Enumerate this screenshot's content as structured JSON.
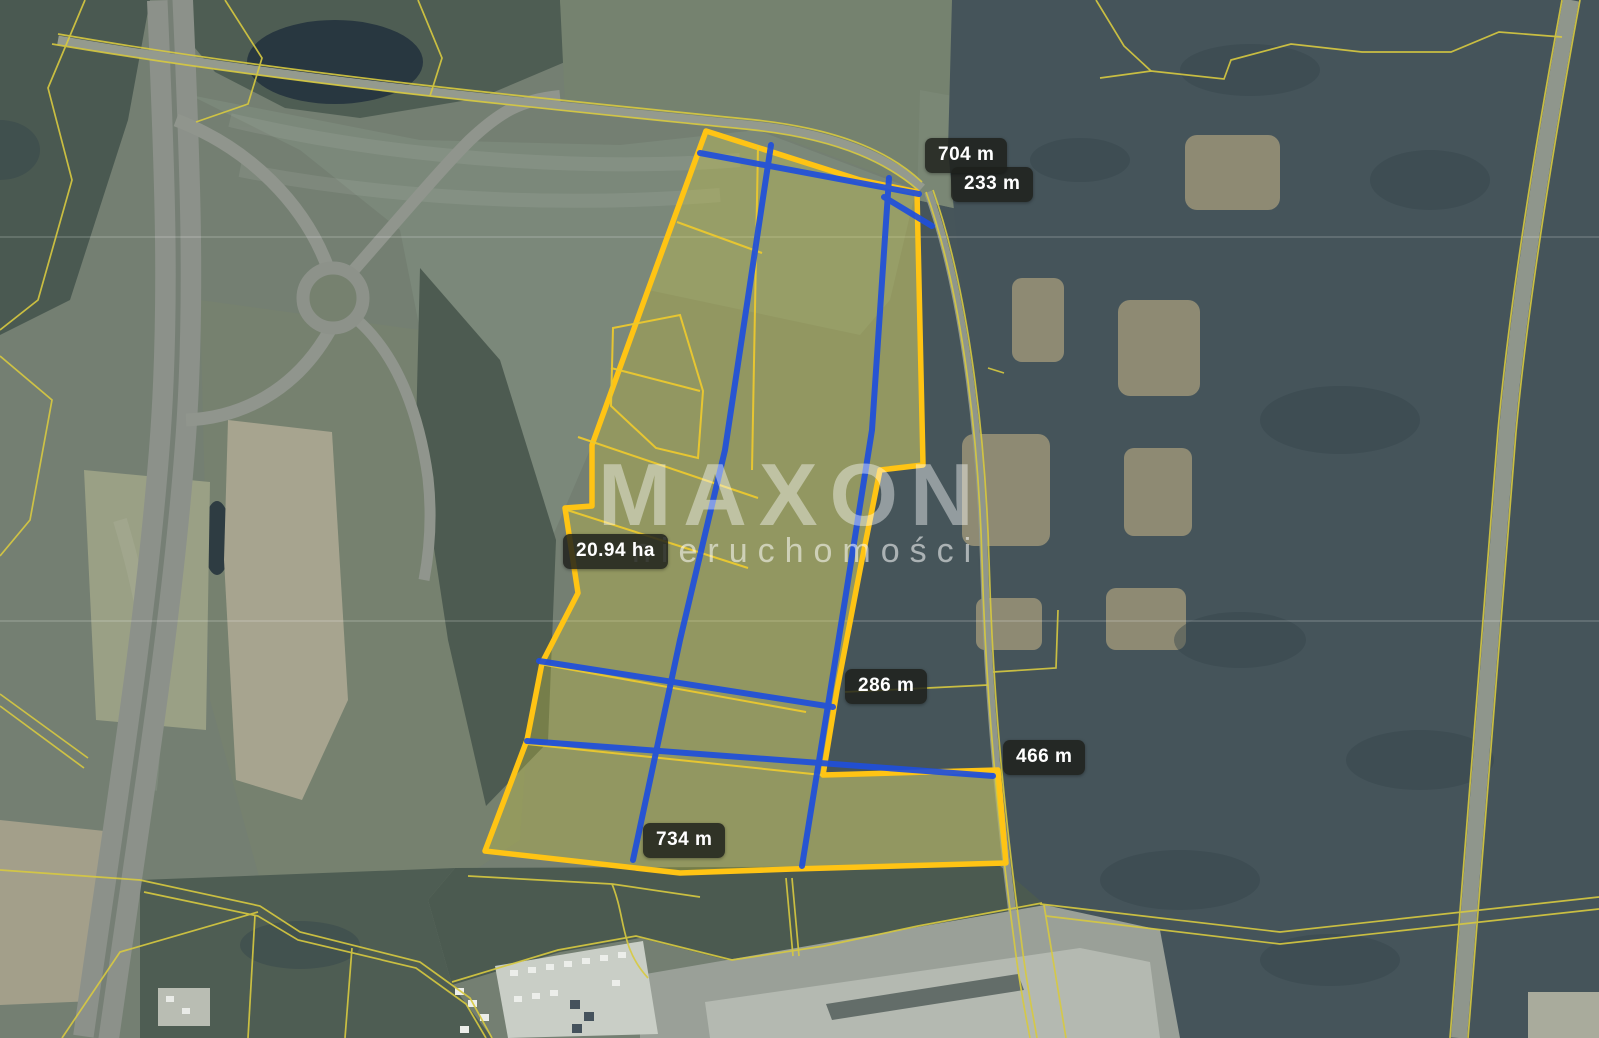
{
  "map": {
    "watermark": {
      "brand": "MAXON",
      "subtitle": "nieruchomości"
    },
    "area_label": "20.94 ha",
    "measurements": [
      {
        "name": "north-edge",
        "label": "704 m"
      },
      {
        "name": "north-right-edge",
        "label": "233 m"
      },
      {
        "name": "east-segment",
        "label": "286 m"
      },
      {
        "name": "southeast-segment",
        "label": "466 m"
      },
      {
        "name": "south-edge",
        "label": "734 m"
      }
    ],
    "colors": {
      "parcel_outline": "#ffc414",
      "parcel_fill": "#d8d23c",
      "measurement_line": "#1f4fdc",
      "cadastral_line": "#d8ca40"
    }
  }
}
